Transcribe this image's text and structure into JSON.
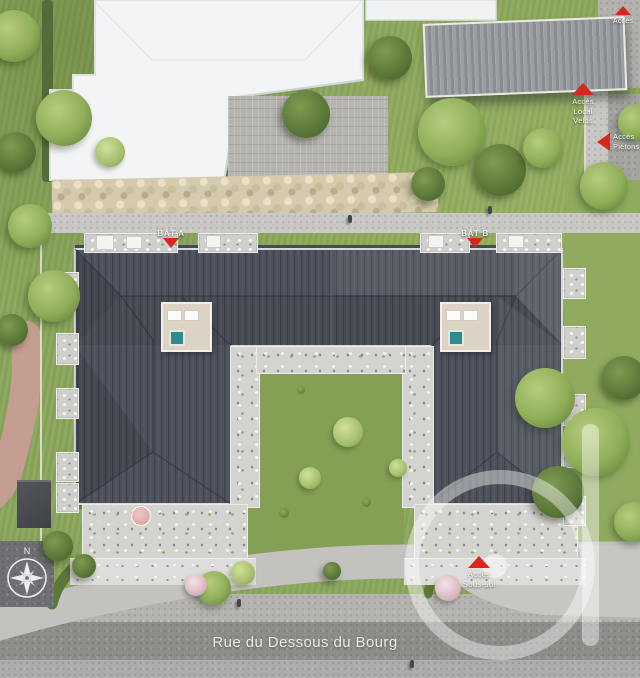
{
  "scene": {
    "description": "Aerial 3D site plan render of a two-building residential programme with landscaped gardens"
  },
  "street": {
    "name": "Rue du Dessous du Bourg"
  },
  "buildings": {
    "bat_a": "BÂT A",
    "bat_b": "BÂT B"
  },
  "markers": {
    "local_velos": {
      "lines": [
        "Accès",
        "Local",
        "Vélos"
      ]
    },
    "pietons": {
      "lines": [
        "Accès",
        "Piétons"
      ]
    },
    "sous_sol": {
      "lines": [
        "Accès",
        "Sous-sol"
      ]
    },
    "top_right": {
      "lines": [
        "Accès"
      ]
    }
  },
  "compass": {
    "north": "N"
  },
  "colors": {
    "marker_red": "#d9271e",
    "roof_slate": "#4c515a",
    "grass": "#8aa65b",
    "road": "#8d8d8a",
    "existing_building_white": "#f3f4f6",
    "rooftop_terrace_beige": "#ddd3c4",
    "spa_teal": "#2e8b8f"
  }
}
